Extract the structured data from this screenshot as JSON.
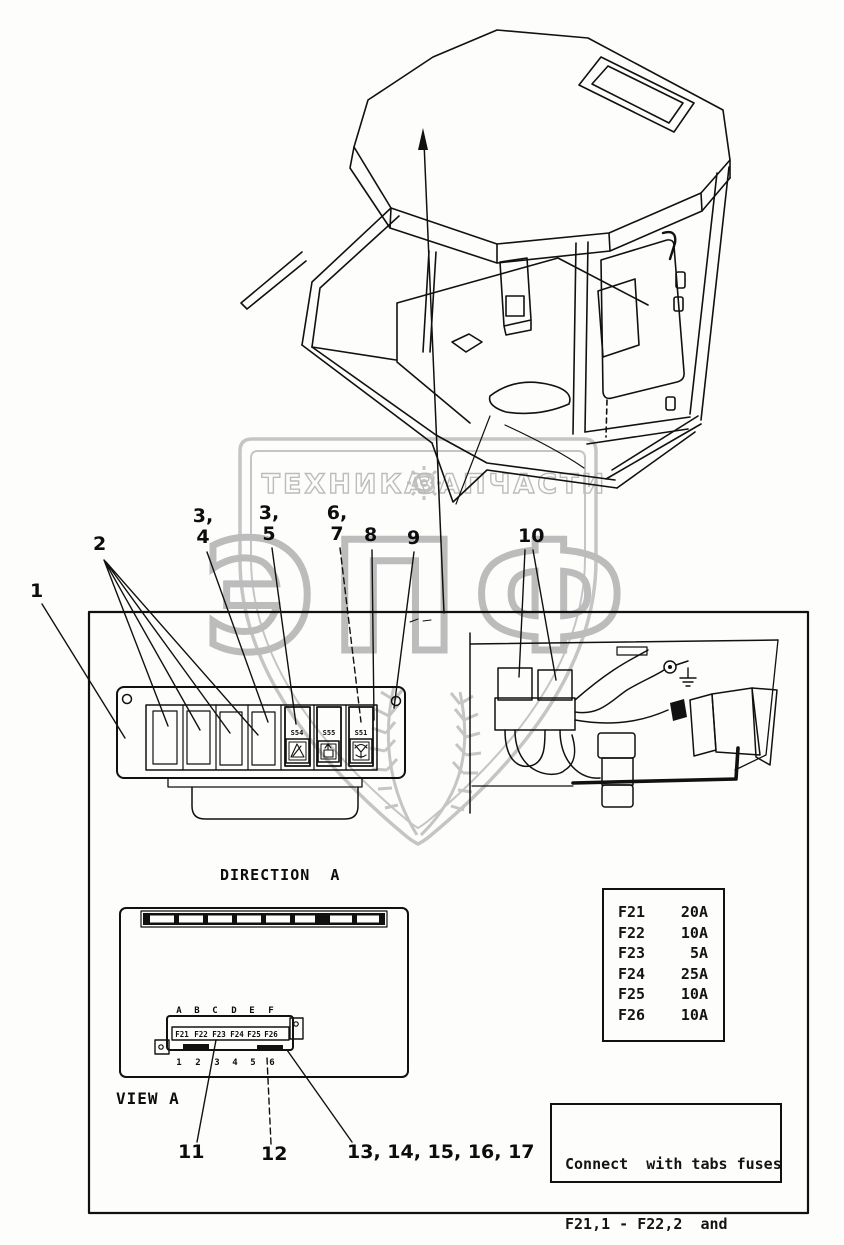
{
  "watermark": {
    "left_text": "ТЕХНИКА",
    "right_text": "ЗАПЧАСТИ",
    "big_text": "ЭПФ"
  },
  "callouts": {
    "c1": "1",
    "c2": "2",
    "c34_top": "3,",
    "c34_bottom": "4",
    "c35_top": "3,",
    "c35_bottom": "5",
    "c67_top": "6,",
    "c67_bottom": "7",
    "c8": "8",
    "c9": "9",
    "c10": "10",
    "c11": "11",
    "c12": "12",
    "c13_17": "13, 14, 15, 16, 17"
  },
  "switch_panel": {
    "switch_labels": [
      "S54",
      "S55",
      "S51"
    ]
  },
  "direction_label": "DIRECTION  A",
  "view_label": "VIEW A",
  "fuse_block": {
    "letters": [
      "A",
      "B",
      "C",
      "D",
      "E",
      "F"
    ],
    "fuse_labels": [
      "F21",
      "F22",
      "F23",
      "F24",
      "F25",
      "F26"
    ],
    "numbers": [
      "1",
      "2",
      "3",
      "4",
      "5",
      "6"
    ]
  },
  "fuse_table": {
    "rows": [
      {
        "fuse": "F21",
        "amp": "20A"
      },
      {
        "fuse": "F22",
        "amp": "10A"
      },
      {
        "fuse": "F23",
        "amp": "5A"
      },
      {
        "fuse": "F24",
        "amp": "25A"
      },
      {
        "fuse": "F25",
        "amp": "10A"
      },
      {
        "fuse": "F26",
        "amp": "10A"
      }
    ]
  },
  "note_box": {
    "line1": "Connect  with tabs fuses",
    "line2": "F21,1 - F22,2  and",
    "line3": "F25,5 - F26,6"
  }
}
